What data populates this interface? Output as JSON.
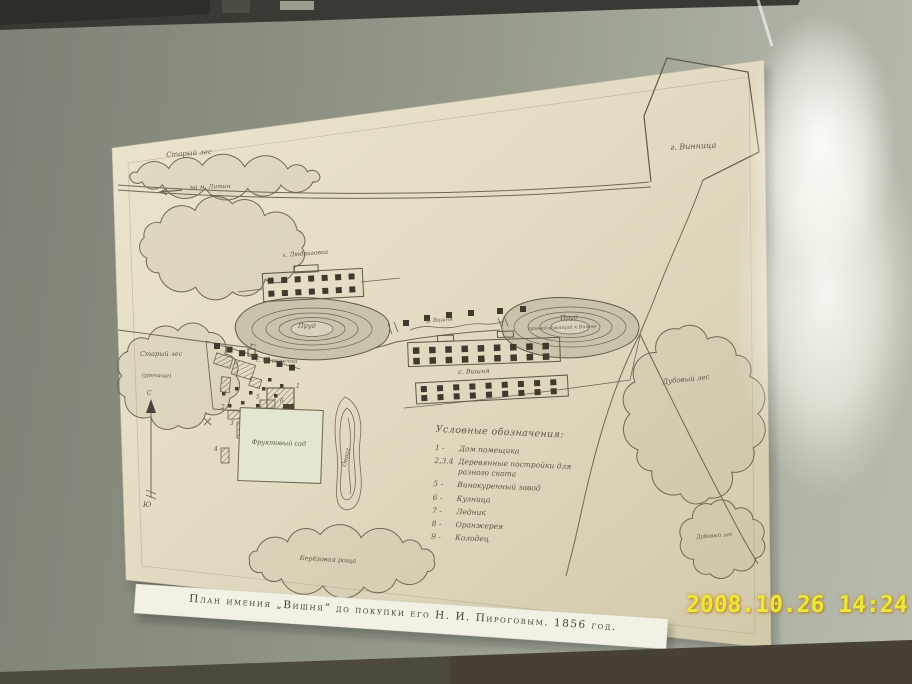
{
  "scene": {
    "timestamp": "2008.10.26 14:24",
    "colors": {
      "wall": "#979c8d",
      "paper": "#e7dfc7",
      "timestamp": "#e9e93a",
      "ink": "#6f6854",
      "garden_fill": "#e3e6d0"
    }
  },
  "caption": "План имения „Вишня“ до покупки его Н. И. Пироговым. 1856 год.",
  "map": {
    "labels": {
      "forest_top": "Старый лес",
      "road_litin": "на м. Литин",
      "vinnitsa": "г. Винница",
      "lyudvigovka": "х. Людвиговка",
      "pond_left": "Пруд",
      "sheremetka": "с. Шереметка",
      "forest_left": "Старый лес",
      "forest_left_note": "(урочище)",
      "river": "р. Вишня",
      "vishnya": "с. Вишня",
      "pond_right": "Пруд",
      "pond_right_note": "принадлежащий к Вишне",
      "oak_forest": "Дубовый лес",
      "oak_forest_small": "Дубовый лес",
      "birch_grove": "Берёзовая роща",
      "garden": "Фруктовый сад",
      "ravine": "Овраг",
      "compass_n": "С",
      "compass_s": "Ю"
    },
    "plot_numbers": [
      "1",
      "2",
      "3",
      "4",
      "5",
      "6"
    ],
    "legend": {
      "title": "Условные обозначения:",
      "items": [
        {
          "num": "1 -",
          "text": "Дом помещика"
        },
        {
          "num": "2,3,4",
          "text": "Деревянные постройки для разного скота"
        },
        {
          "num": "5 -",
          "text": "Винокуренный завод"
        },
        {
          "num": "6 -",
          "text": "Кузница"
        },
        {
          "num": "7 -",
          "text": "Ледник"
        },
        {
          "num": "8 -",
          "text": "Оранжерея"
        },
        {
          "num": "9 -",
          "text": "Колодец"
        }
      ]
    }
  }
}
